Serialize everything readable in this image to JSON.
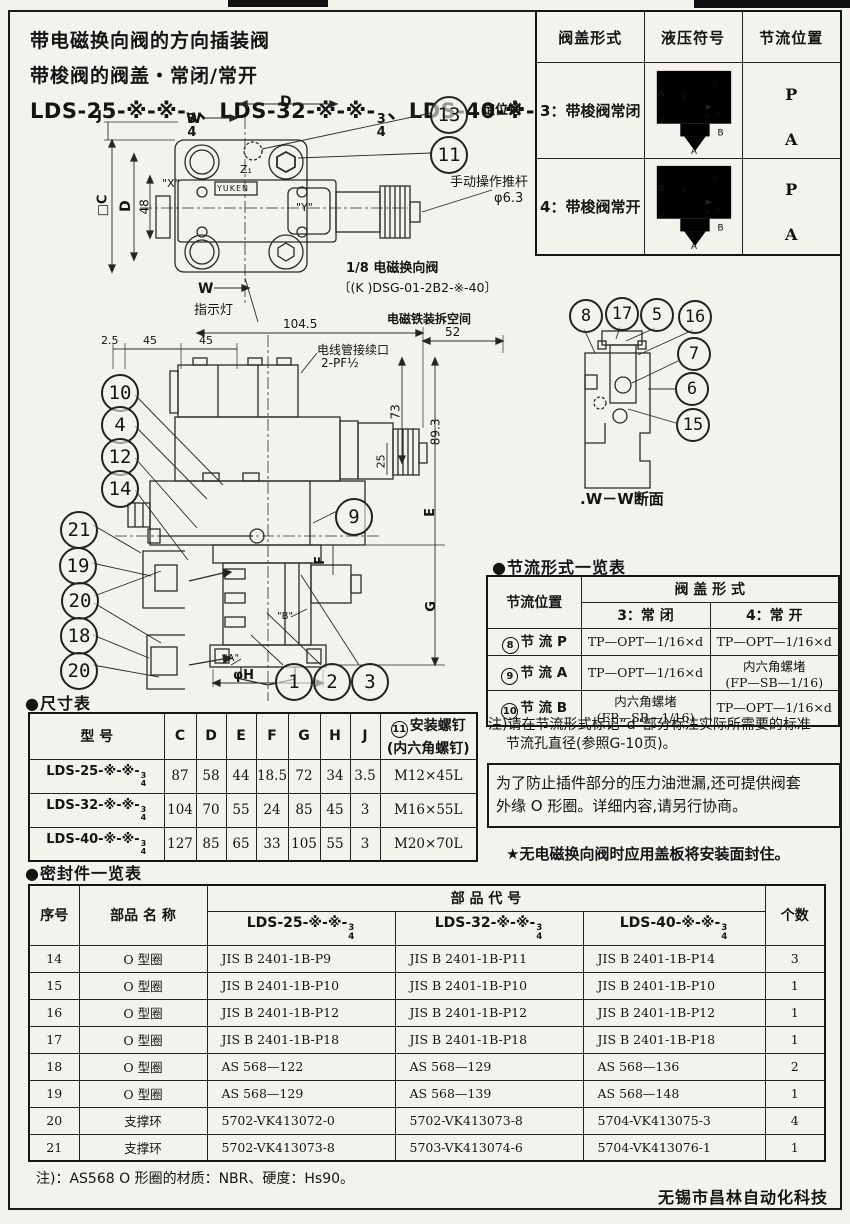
{
  "header": {
    "title_line1": "带电磁换向阀的方向插装阀",
    "title_line2": "带梭阀的阀盖・常闭/常开",
    "models": [
      {
        "prefix": "LDS-25-※-※-",
        "num": "3",
        "den": "4",
        "sep": "、"
      },
      {
        "prefix": "LDS-32-※-※-",
        "num": "3",
        "den": "4",
        "sep": "、"
      },
      {
        "prefix": "LDS-40-※-※-",
        "num": "3",
        "den": "4",
        "sep": ""
      }
    ]
  },
  "cover_table": {
    "headers": [
      "阀盖形式",
      "液压符号",
      "节流位置"
    ],
    "rows": [
      {
        "form": "3：带梭阀常闭",
        "pos_top": "P",
        "pos_bottom": "A",
        "sym": {
          "left": "A",
          "p": "P",
          "b": "b",
          "x": "X",
          "z": "Z",
          "y": "Y",
          "right": "B",
          "bottom": "A"
        }
      },
      {
        "form": "4：带梭阀常开",
        "pos_top": "P",
        "pos_bottom": "A",
        "sym": {
          "left": "B",
          "p": "P",
          "b": "b",
          "x": "X",
          "z": "Z",
          "y": "Y",
          "right": "B",
          "bottom": "A"
        }
      }
    ]
  },
  "top_view": {
    "callout_pin": "13",
    "callout_bolt": "11",
    "pin_label": "定位销",
    "rod_label": "手动操作推杆",
    "rod_dia": "φ6.3",
    "indicator_label": "指示灯",
    "solenoid_valve_label": "1/8 电磁换向阀",
    "solenoid_valve_model": "〔(K )DSG-01-2B2-※-40〕",
    "brand": "YUKEN",
    "ports": {
      "x": "\"X\"",
      "y": "\"Y\"",
      "z": "Z₁"
    },
    "dims": {
      "d_top": "D",
      "w_top": "W",
      "w_bottom": "W",
      "j": "J",
      "c": "□C",
      "d_left": "D",
      "h48": "48"
    }
  },
  "front_view": {
    "space_label": "电磁铁装拆空间",
    "conduit_label": "电线管接续口",
    "conduit_size": "2-PF½",
    "dims": {
      "d2_5": "2.5",
      "d45a": "45",
      "d45b": "45",
      "d104_5": "104.5",
      "d52": "52",
      "d73": "73",
      "d89_3": "89.3",
      "d25": "25",
      "e": "E",
      "f": "F",
      "g": "G",
      "phi_h": "φH"
    },
    "port_a": "\"A\"",
    "port_b": "\"B\"",
    "callouts_left": [
      "10",
      "4",
      "12",
      "14"
    ],
    "callouts_lower_left": [
      "21",
      "19",
      "20",
      "18",
      "20"
    ],
    "callouts_bottom": [
      "1",
      "2",
      "3"
    ],
    "callout_right": "9"
  },
  "section_view": {
    "callouts": [
      "8",
      "17",
      "5",
      "16",
      "7",
      "6",
      "15"
    ],
    "caption": ".W－W断面"
  },
  "throttle_table": {
    "title": "●节流形式一览表",
    "pos_header": "节流位置",
    "form_header": "阀  盖  形  式",
    "form_closed": "3：常    闭",
    "form_open": "4：常    开",
    "rows": [
      {
        "num": "8",
        "pos": "节  流  P",
        "closed_l1": "TP—OPT—1/16×d",
        "closed_l2": "",
        "open_l1": "TP—OPT—1/16×d",
        "open_l2": ""
      },
      {
        "num": "9",
        "pos": "节  流  A",
        "closed_l1": "TP—OPT—1/16×d",
        "closed_l2": "",
        "open_l1": "内六角螺堵",
        "open_l2": "(FP—SB—1/16)"
      },
      {
        "num": "10",
        "pos": "节  流  B",
        "closed_l1": "内六角螺堵",
        "closed_l2": "(FP—SB—1/16)",
        "open_l1": "TP—OPT—1/16×d",
        "open_l2": ""
      }
    ],
    "note_line1": "注)请在节流形式标记“d”部分标注实际所需要的标准",
    "note_line2": "节流孔直径(参照G-10页)。"
  },
  "leak_note": {
    "line1": "为了防止插件部分的压力油泄漏,还可提供阀套",
    "line2": "外缘 O 形圈。详细内容,请另行协商。"
  },
  "star_note": "★无电磁换向阀时应用盖板将安装面封住。",
  "dim_table": {
    "title": "●尺寸表",
    "model_header": "型        号",
    "cols": [
      "C",
      "D",
      "E",
      "F",
      "G",
      "H",
      "J"
    ],
    "screw_num": "11",
    "screw_header_l1": "安装螺钉",
    "screw_header_l2": "(内六角螺钉)",
    "rows": [
      {
        "prefix": "LDS-25-※-※-",
        "num": "3",
        "den": "4",
        "vals": [
          "87",
          "58",
          "44",
          "18.5",
          "72",
          "34",
          "3.5"
        ],
        "screw": "M12×45L"
      },
      {
        "prefix": "LDS-32-※-※-",
        "num": "3",
        "den": "4",
        "vals": [
          "104",
          "70",
          "55",
          "24",
          "85",
          "45",
          "3"
        ],
        "screw": "M16×55L"
      },
      {
        "prefix": "LDS-40-※-※-",
        "num": "3",
        "den": "4",
        "vals": [
          "127",
          "85",
          "65",
          "33",
          "105",
          "55",
          "3"
        ],
        "screw": "M20×70L"
      }
    ]
  },
  "seal_table": {
    "title": "●密封件一览表",
    "sn_header": "序号",
    "name_header": "部品 名 称",
    "code_header": "部        品        代        号",
    "qty_header": "个数",
    "models": [
      {
        "prefix": "LDS-25-※-※-",
        "num": "3",
        "den": "4"
      },
      {
        "prefix": "LDS-32-※-※-",
        "num": "3",
        "den": "4"
      },
      {
        "prefix": "LDS-40-※-※-",
        "num": "3",
        "den": "4"
      }
    ],
    "rows": [
      {
        "sn": "14",
        "name": "O 型圈",
        "codes": [
          "JIS B 2401-1B-P9",
          "JIS B 2401-1B-P11",
          "JIS B 2401-1B-P14"
        ],
        "qty": "3"
      },
      {
        "sn": "15",
        "name": "O 型圈",
        "codes": [
          "JIS B 2401-1B-P10",
          "JIS B 2401-1B-P10",
          "JIS B 2401-1B-P10"
        ],
        "qty": "1"
      },
      {
        "sn": "16",
        "name": "O 型圈",
        "codes": [
          "JIS B 2401-1B-P12",
          "JIS B 2401-1B-P12",
          "JIS B 2401-1B-P12"
        ],
        "qty": "1"
      },
      {
        "sn": "17",
        "name": "O 型圈",
        "codes": [
          "JIS B 2401-1B-P18",
          "JIS B 2401-1B-P18",
          "JIS B 2401-1B-P18"
        ],
        "qty": "1"
      },
      {
        "sn": "18",
        "name": "O 型圈",
        "codes": [
          "AS 568—122",
          "AS 568—129",
          "AS 568—136"
        ],
        "qty": "2"
      },
      {
        "sn": "19",
        "name": "O 型圈",
        "codes": [
          "AS 568—129",
          "AS 568—139",
          "AS 568—148"
        ],
        "qty": "1"
      },
      {
        "sn": "20",
        "name": "支撑环",
        "codes": [
          "5702-VK413072-0",
          "5702-VK413073-8",
          "5704-VK413075-3"
        ],
        "qty": "4"
      },
      {
        "sn": "21",
        "name": "支撑环",
        "codes": [
          "5702-VK413073-8",
          "5703-VK413074-6",
          "5704-VK413076-1"
        ],
        "qty": "1"
      }
    ],
    "note": "注)：AS568 O 形圈的材质：NBR、硬度：Hs90。"
  },
  "footer": "无锡市昌林自动化科技"
}
